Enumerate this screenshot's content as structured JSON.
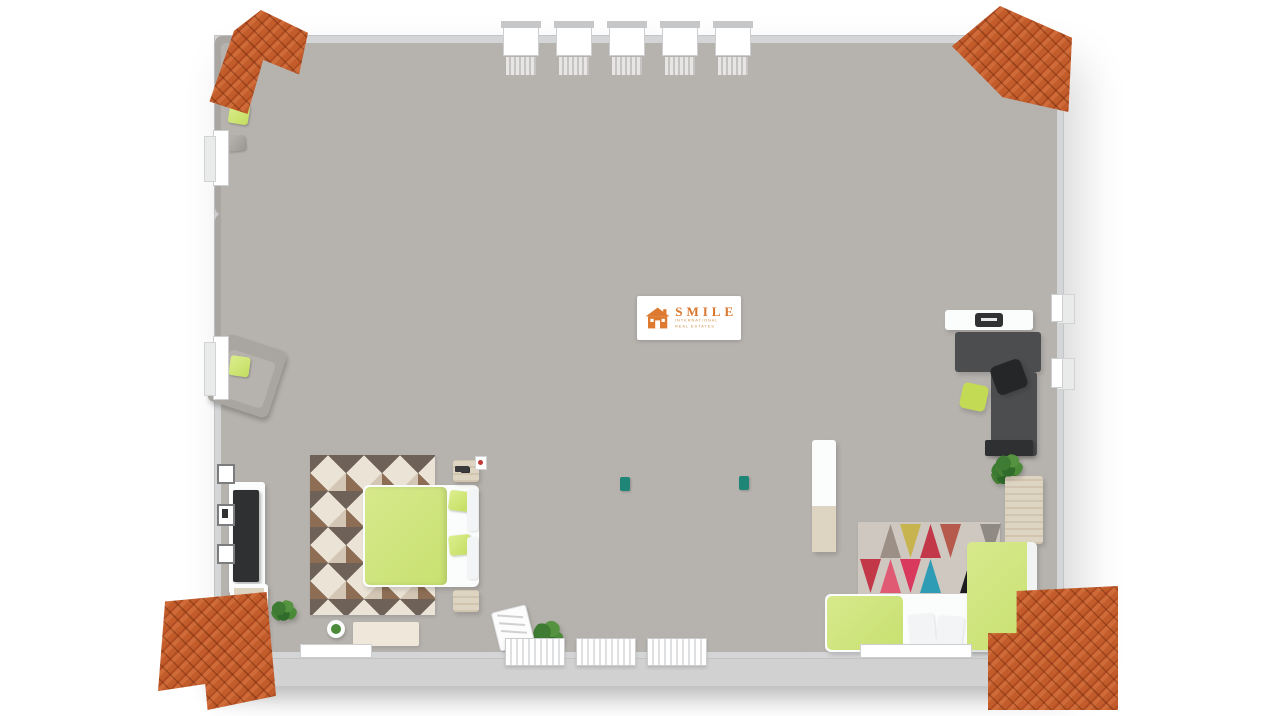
{
  "watermark": {
    "brand": "SMILE",
    "subtitle_line1": "INTERNATIONAL",
    "subtitle_line2": "REAL ESTATES"
  },
  "scene": {
    "type": "3D floor plan render, top-down isometric view of one floor",
    "corner_decorations": "terracotta roof tile corner pieces at all four image corners",
    "rooms": [
      {
        "name": "sauna-bathroom",
        "position": "top-left",
        "features": [
          "wood panelled sauna",
          "bathtub",
          "glass shower",
          "vanity with drawers",
          "gray tile floor"
        ]
      },
      {
        "name": "landing-lounge",
        "position": "top-center",
        "features": [
          "two gray armchairs with green pillows",
          "dark blue rug with white emblem",
          "staircase with dark railings and glass panel",
          "row of windows",
          "potted plant",
          "teal side tables"
        ]
      },
      {
        "name": "main-bathroom",
        "position": "top-right",
        "features": [
          "corner bathtub",
          "double-sink vanity with mirror",
          "toilet",
          "bidet",
          "gray tile floor"
        ]
      },
      {
        "name": "home-office-nook",
        "position": "right",
        "features": [
          "L-shaped dark desk",
          "black office chair",
          "green chair",
          "wall shelf with printer",
          "plant"
        ]
      },
      {
        "name": "bedroom-2",
        "position": "bottom-right",
        "features": [
          "bed with green bedding",
          "multicolor triangle rug",
          "wooden dresser",
          "white cabinet",
          "plant",
          "dark TV panel"
        ]
      },
      {
        "name": "living-room",
        "position": "bottom-center",
        "features": [
          "gray loveseat",
          "long gray sofa",
          "gray armchair",
          "green accent pillows",
          "patchwork rug with white emblem",
          "long drawer sideboard",
          "plant",
          "magazine rack",
          "radiators under windows"
        ]
      },
      {
        "name": "master-bedroom",
        "position": "bottom-left",
        "features": [
          "double bed with green bedding",
          "chevron zigzag rug",
          "wall-mounted TV",
          "three picture frames",
          "two nightstands",
          "dresser",
          "bench runner",
          "stool",
          "plant"
        ]
      },
      {
        "name": "hallway",
        "position": "center-left",
        "features": [
          "wood-top shelf sideboard",
          "potted plant",
          "light switches"
        ]
      }
    ]
  },
  "palette": {
    "background": "#ffffff",
    "wall": "#d7d8d9",
    "wood_floor": "#e0e1e3",
    "tile_floor": "#8f9499",
    "sauna_wood": "#d2ab71",
    "roof_tile": "#c75f2e",
    "furniture_gray": "#a9a5a1",
    "accent_green": "#cde27c",
    "rug_navy": "#18242f",
    "logo_orange": "#d9752c"
  },
  "windows": {
    "top_count": 5,
    "bottom_radiator_count": 3
  },
  "rug_triangles": {
    "rows": [
      [
        "",
        "#9b8f86",
        "#c8b44e",
        "#c23848",
        "#b65a4e",
        "",
        "#8f8a84"
      ],
      [
        "#c23848",
        "#e05a74",
        "#d8395c",
        "#2e9cb4",
        "",
        "#1d1d1f",
        "#8f4a5a"
      ],
      [
        "",
        "#d8607a",
        "#c23848",
        "#b0a194",
        "#e05a74",
        "#6e5f68",
        ""
      ]
    ]
  }
}
